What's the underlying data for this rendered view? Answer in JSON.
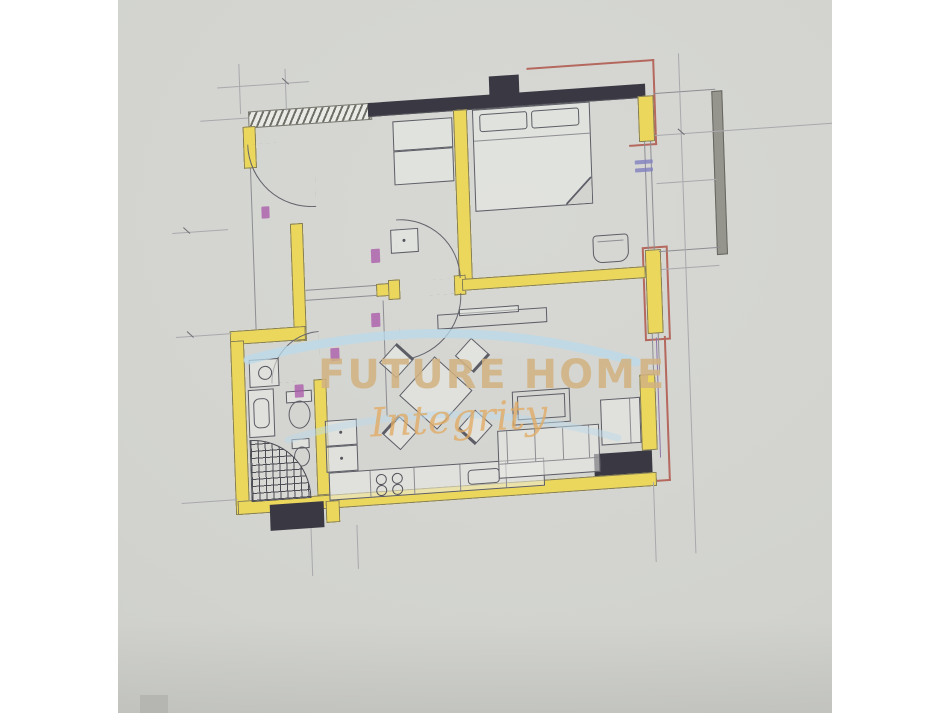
{
  "image_type": "real-estate floor plan photo",
  "watermark": {
    "brand": "FUTURE HOME",
    "tagline": "Integrity"
  },
  "colors": {
    "paper": "#d3d4d0",
    "wall_black": "#3a3943",
    "wall_yellow": "#ecd75d",
    "outline_red": "#b4685e",
    "line_gray": "#8d8d93",
    "railing_gray": "#95958d",
    "watermark_tan": "#d1b280",
    "watermark_blue": "#b9d9ea",
    "dim_magenta": "#a855a8",
    "dim_blue": "#7f7fc0"
  },
  "floor_plan": {
    "type": "apartment",
    "rooms": [
      {
        "name": "bedroom",
        "furniture": [
          "double-bed",
          "pillows",
          "wardrobe",
          "side-square"
        ]
      },
      {
        "name": "entry-hall",
        "furniture": [
          "entry-door",
          "door-swing-arcs"
        ]
      },
      {
        "name": "bathroom",
        "furniture": [
          "washing-machine",
          "vanity-sink",
          "toilet",
          "bidet",
          "corner-shower"
        ]
      },
      {
        "name": "living-kitchen",
        "furniture": [
          "kitchen-counter",
          "stove-4-burner",
          "base-cabinets",
          "dining-table",
          "chairs-x4",
          "sofa",
          "armchair",
          "coffee-table",
          "tv-console",
          "wall-fixture"
        ]
      },
      {
        "name": "balcony",
        "furniture": [
          "railing"
        ]
      }
    ],
    "annotations": [
      "dimension-lines",
      "door-swing-arcs",
      "magenta-dimension-marks",
      "blue-window-mark",
      "red-boundary-outline"
    ]
  }
}
